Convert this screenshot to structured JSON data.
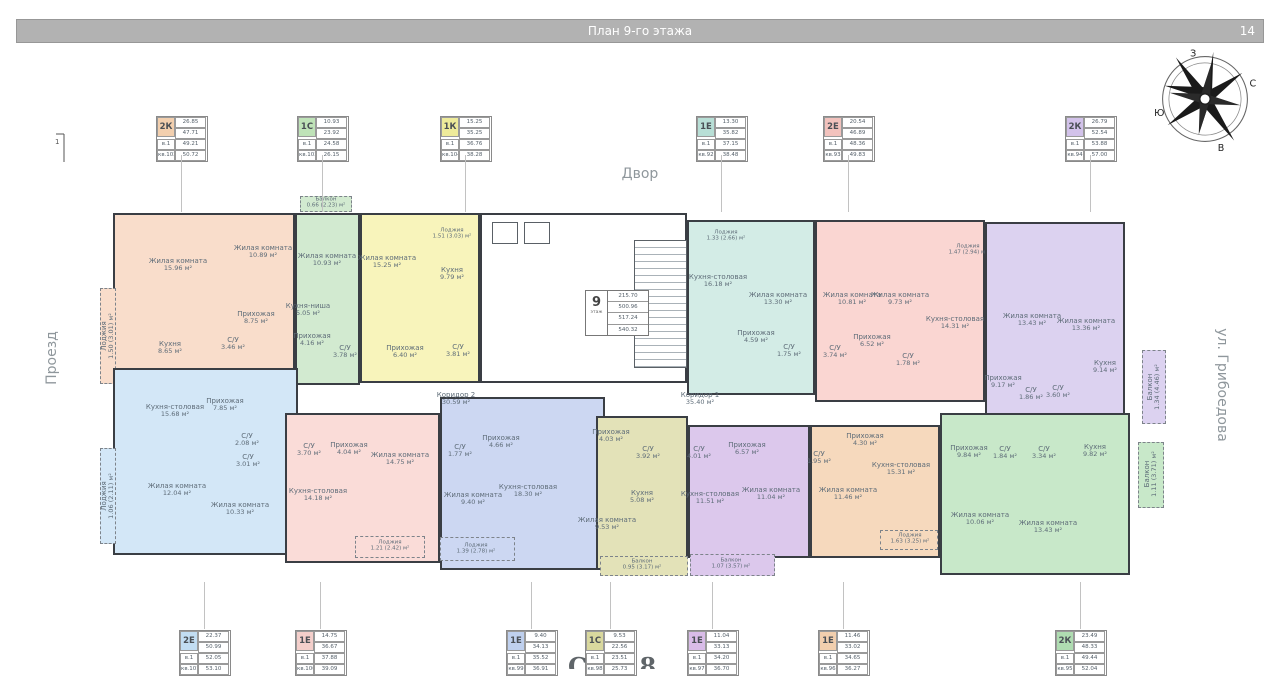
{
  "header": {
    "title": "План 9-го этажа",
    "page": "14"
  },
  "environment": {
    "top": "Двор",
    "left": "Проезд",
    "right": "ул. Грибоедова",
    "section_mark": "1"
  },
  "compass": {
    "n": "С",
    "e": "В",
    "s": "Ю",
    "w": "З"
  },
  "floor_box": {
    "floor": "9",
    "floor_label": "этаж",
    "values": [
      "215.70",
      "500.96",
      "517.24",
      "540.32"
    ]
  },
  "corridors": [
    {
      "name": "Коридор 2",
      "area": "30.59 м²"
    },
    {
      "name": "Коридор 1",
      "area": "35.40 м²"
    }
  ],
  "core": {
    "rooms": [
      {
        "name": "Незадымляемая лоджия",
        "area": "5.77 м²"
      },
      {
        "name": "Тамбур",
        "area": "3.40 м²"
      },
      {
        "name": "Л/к",
        "area": "4.70 м²"
      },
      {
        "name": "Лифтовый холл",
        "area": "21.72 м²"
      },
      {
        "name": "Л/к",
        "area": "3.09 м²"
      }
    ]
  },
  "apartments": [
    {
      "id": "kv102",
      "type": "2К",
      "rooms": [
        {
          "name": "Жилая комната",
          "area": "15.96 м²"
        },
        {
          "name": "Жилая комната",
          "area": "10.89 м²"
        },
        {
          "name": "Прихожая",
          "area": "8.75 м²"
        },
        {
          "name": "Кухня",
          "area": "8.65 м²"
        },
        {
          "name": "С/У",
          "area": "3.46 м²"
        },
        {
          "name": "Лоджия",
          "area": "1.50 (3.01) м²"
        }
      ]
    },
    {
      "id": "kv103",
      "type": "1С",
      "rooms": [
        {
          "name": "Балкон",
          "area": "0.66 (2.23) м²"
        },
        {
          "name": "Жилая комната",
          "area": "10.93 м²"
        },
        {
          "name": "Кухня-ниша",
          "area": "5.05 м²"
        },
        {
          "name": "Прихожая",
          "area": "4.16 м²"
        },
        {
          "name": "С/У",
          "area": "3.78 м²"
        }
      ]
    },
    {
      "id": "kv104",
      "type": "1К",
      "rooms": [
        {
          "name": "Лоджия",
          "area": "1.51 (3.03) м²"
        },
        {
          "name": "Жилая комната",
          "area": "15.25 м²"
        },
        {
          "name": "Кухня",
          "area": "9.79 м²"
        },
        {
          "name": "Прихожая",
          "area": "6.40 м²"
        },
        {
          "name": "С/У",
          "area": "3.81 м²"
        }
      ]
    },
    {
      "id": "kv92",
      "type": "1Е",
      "rooms": [
        {
          "name": "Лоджия",
          "area": "1.33 (2.66) м²"
        },
        {
          "name": "Кухня-столовая",
          "area": "16.18 м²"
        },
        {
          "name": "Жилая комната",
          "area": "13.30 м²"
        },
        {
          "name": "Прихожая",
          "area": "4.59 м²"
        },
        {
          "name": "С/У",
          "area": "1.75 м²"
        }
      ]
    },
    {
      "id": "kv93",
      "type": "2Е",
      "rooms": [
        {
          "name": "Лоджия",
          "area": "1.47 (2.94) м²"
        },
        {
          "name": "Жилая комната",
          "area": "10.81 м²"
        },
        {
          "name": "Жилая комната",
          "area": "9.73 м²"
        },
        {
          "name": "Прихожая",
          "area": "6.52 м²"
        },
        {
          "name": "С/У",
          "area": "3.74 м²"
        },
        {
          "name": "С/У",
          "area": "1.78 м²"
        },
        {
          "name": "Кухня-столовая",
          "area": "14.31 м²"
        }
      ]
    },
    {
      "id": "kv94",
      "type": "2К",
      "rooms": [
        {
          "name": "Жилая комната",
          "area": "13.43 м²"
        },
        {
          "name": "Жилая комната",
          "area": "13.36 м²"
        },
        {
          "name": "Прихожая",
          "area": "9.17 м²"
        },
        {
          "name": "С/У",
          "area": "1.86 м²"
        },
        {
          "name": "С/У",
          "area": "3.60 м²"
        },
        {
          "name": "Кухня",
          "area": "9.14 м²"
        },
        {
          "name": "Балкон",
          "area": "1.34 (4.46) м²"
        }
      ]
    },
    {
      "id": "kv101",
      "type": "2Е",
      "rooms": [
        {
          "name": "Кухня-столовая",
          "area": "15.68 м²"
        },
        {
          "name": "Прихожая",
          "area": "7.85 м²"
        },
        {
          "name": "С/У",
          "area": "2.08 м²"
        },
        {
          "name": "С/У",
          "area": "3.01 м²"
        },
        {
          "name": "Жилая комната",
          "area": "12.04 м²"
        },
        {
          "name": "Жилая комната",
          "area": "10.33 м²"
        },
        {
          "name": "Лоджия",
          "area": "1.06 (2.11) м²"
        }
      ]
    },
    {
      "id": "kv100",
      "type": "1Е",
      "rooms": [
        {
          "name": "С/У",
          "area": "3.70 м²"
        },
        {
          "name": "Прихожая",
          "area": "4.04 м²"
        },
        {
          "name": "Кухня-столовая",
          "area": "14.18 м²"
        },
        {
          "name": "Жилая комната",
          "area": "14.75 м²"
        },
        {
          "name": "Лоджия",
          "area": "1.21 (2.42) м²"
        }
      ]
    },
    {
      "id": "kv99",
      "type": "1Е",
      "rooms": [
        {
          "name": "С/У",
          "area": "1.77 м²"
        },
        {
          "name": "Прихожая",
          "area": "4.66 м²"
        },
        {
          "name": "Жилая комната",
          "area": "9.40 м²"
        },
        {
          "name": "Кухня-столовая",
          "area": "18.30 м²"
        },
        {
          "name": "Лоджия",
          "area": "1.39 (2.78) м²"
        }
      ]
    },
    {
      "id": "kv98",
      "type": "1С",
      "rooms": [
        {
          "name": "Прихожая",
          "area": "4.03 м²"
        },
        {
          "name": "С/У",
          "area": "3.92 м²"
        },
        {
          "name": "Кухня",
          "area": "5.08 м²"
        },
        {
          "name": "Жилая комната",
          "area": "9.53 м²"
        },
        {
          "name": "Балкон",
          "area": "0.95 (3.17) м²"
        }
      ]
    },
    {
      "id": "kv97",
      "type": "1Е",
      "rooms": [
        {
          "name": "С/У",
          "area": "4.01 м²"
        },
        {
          "name": "Прихожая",
          "area": "6.57 м²"
        },
        {
          "name": "Кухня-столовая",
          "area": "11.51 м²"
        },
        {
          "name": "Жилая комната",
          "area": "11.04 м²"
        },
        {
          "name": "Балкон",
          "area": "1.07 (3.57) м²"
        }
      ]
    },
    {
      "id": "kv96",
      "type": "1Е",
      "rooms": [
        {
          "name": "С/У",
          "area": "1.95 м²"
        },
        {
          "name": "Прихожая",
          "area": "4.30 м²"
        },
        {
          "name": "Кухня-столовая",
          "area": "15.31 м²"
        },
        {
          "name": "Жилая комната",
          "area": "11.46 м²"
        },
        {
          "name": "Лоджия",
          "area": "1.63 (3.25) м²"
        }
      ]
    },
    {
      "id": "kv95",
      "type": "2К",
      "rooms": [
        {
          "name": "Прихожая",
          "area": "9.84 м²"
        },
        {
          "name": "С/У",
          "area": "1.84 м²"
        },
        {
          "name": "С/У",
          "area": "3.34 м²"
        },
        {
          "name": "Кухня",
          "area": "9.82 м²"
        },
        {
          "name": "Жилая комната",
          "area": "10.06 м²"
        },
        {
          "name": "Жилая комната",
          "area": "13.43 м²"
        },
        {
          "name": "Балкон",
          "area": "1.11 (3.71) м²"
        }
      ]
    }
  ],
  "stamps": {
    "top": [
      {
        "type": "2К",
        "values": [
          "26.85",
          "47.71",
          "49.21",
          "50.72"
        ],
        "entrance": "в.1",
        "unit": "кв.102",
        "color": "#f2cfae"
      },
      {
        "type": "1С",
        "values": [
          "10.93",
          "23.92",
          "24.58",
          "26.15"
        ],
        "entrance": "в.1",
        "unit": "кв.103",
        "color": "#bfe3b8"
      },
      {
        "type": "1К",
        "values": [
          "15.25",
          "35.25",
          "36.76",
          "38.28"
        ],
        "entrance": "в.1",
        "unit": "кв.104",
        "color": "#eeeb9a"
      },
      {
        "type": "1Е",
        "values": [
          "13.30",
          "35.82",
          "37.15",
          "38.48"
        ],
        "entrance": "в.1",
        "unit": "кв.92",
        "color": "#b8dfd6"
      },
      {
        "type": "2Е",
        "values": [
          "20.54",
          "46.89",
          "48.36",
          "49.83"
        ],
        "entrance": "в.1",
        "unit": "кв.93",
        "color": "#f2c2bd"
      },
      {
        "type": "2К",
        "values": [
          "26.79",
          "52.54",
          "53.88",
          "57.00"
        ],
        "entrance": "в.1",
        "unit": "кв.94",
        "color": "#d2c2ea"
      }
    ],
    "bottom": [
      {
        "type": "2Е",
        "values": [
          "22.37",
          "50.99",
          "52.05",
          "53.10"
        ],
        "entrance": "в.1",
        "unit": "кв.101",
        "color": "#c2ddf2"
      },
      {
        "type": "1Е",
        "values": [
          "14.75",
          "36.67",
          "37.88",
          "39.09"
        ],
        "entrance": "в.1",
        "unit": "кв.100",
        "color": "#f4cfcb"
      },
      {
        "type": "1Е",
        "values": [
          "9.40",
          "34.13",
          "35.52",
          "36.91"
        ],
        "entrance": "в.1",
        "unit": "кв.99",
        "color": "#bfd0ee"
      },
      {
        "type": "1С",
        "values": [
          "9.53",
          "22.56",
          "23.51",
          "25.73"
        ],
        "entrance": "в.1",
        "unit": "кв.98",
        "color": "#d9d89e"
      },
      {
        "type": "1Е",
        "values": [
          "11.04",
          "33.13",
          "34.20",
          "36.70"
        ],
        "entrance": "в.1",
        "unit": "кв.97",
        "color": "#d9bce8"
      },
      {
        "type": "1Е",
        "values": [
          "11.46",
          "33.02",
          "34.65",
          "36.27"
        ],
        "entrance": "в.1",
        "unit": "кв.96",
        "color": "#f2cfae"
      },
      {
        "type": "2К",
        "values": [
          "23.49",
          "48.33",
          "49.44",
          "52.04"
        ],
        "entrance": "в.1",
        "unit": "кв.95",
        "color": "#afdcb1"
      }
    ]
  },
  "bottom_cutoff": "С 8"
}
